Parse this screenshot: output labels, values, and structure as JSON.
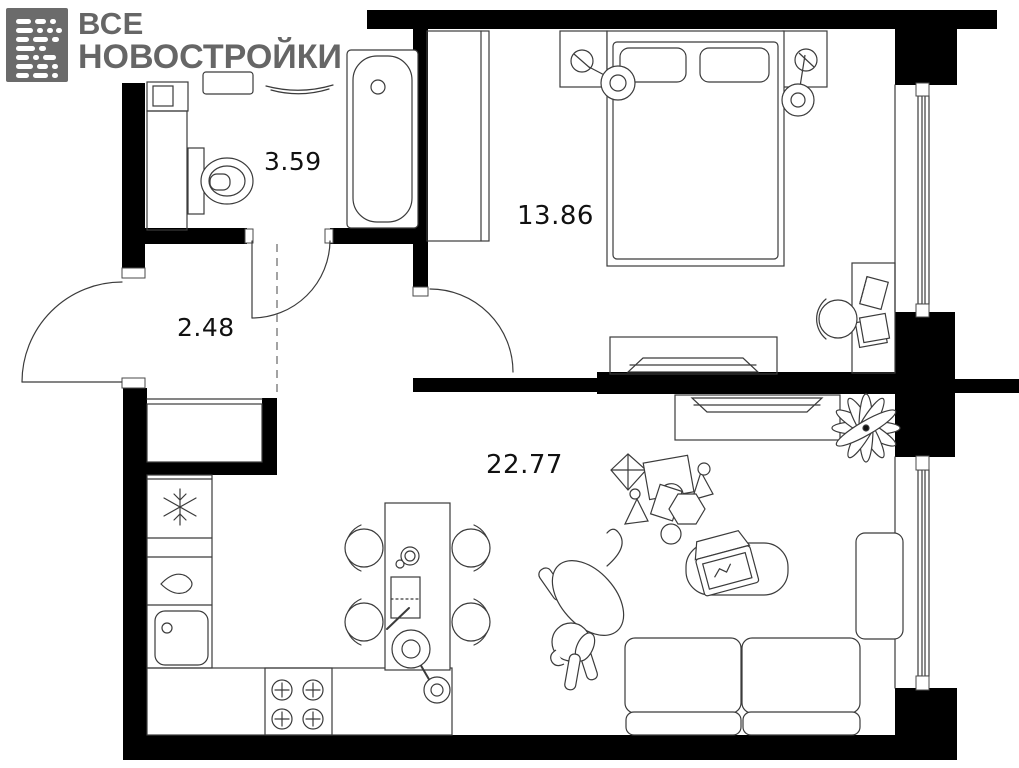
{
  "logo": {
    "line1": "ВСЕ",
    "line2": "НОВОСТРОЙКИ",
    "text_color": "#666666",
    "mark_color": "#6b6b6b"
  },
  "plan": {
    "wall_color": "#000000",
    "line_color": "#3b3b3b",
    "rooms": [
      {
        "name": "bathroom",
        "area_label": "3.59"
      },
      {
        "name": "hallway",
        "area_label": "2.48"
      },
      {
        "name": "bedroom",
        "area_label": "13.86"
      },
      {
        "name": "living-kitchen",
        "area_label": "22.77"
      }
    ],
    "icons": [
      "washing-machine-icon",
      "vanity-icon",
      "toilet-icon",
      "bathtub-icon",
      "entrance-door-arc",
      "bathroom-door-arc",
      "bedroom-door-arc",
      "closet-icon",
      "wardrobe-icon",
      "double-bed-icon",
      "pillow-icon",
      "pendant-lamp-icon",
      "bedside-table-icon",
      "desk-icon",
      "desk-chair-icon",
      "tv-console-icon",
      "window-icon",
      "fridge-icon",
      "kitchen-sink-icon",
      "stove-icon",
      "dining-table-icon",
      "chair-icon",
      "plant-icon",
      "toy-icons",
      "laptop-icon",
      "pouf-icon",
      "dog-icon",
      "sofa-icon"
    ]
  }
}
